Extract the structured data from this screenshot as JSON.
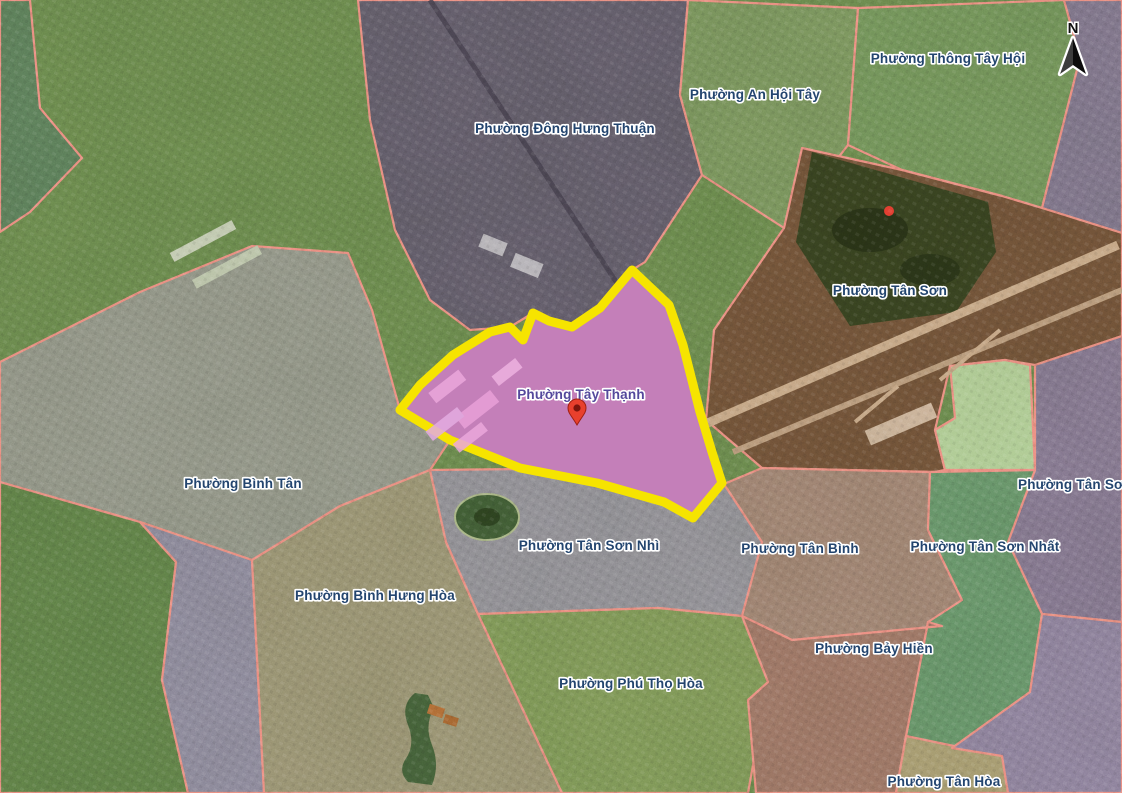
{
  "map": {
    "type": "satellite-ward-boundary-map",
    "highlighted_ward": "Phường Tây Thạnh",
    "compass_label": "N",
    "colors": {
      "highlight_fill": "#d47cc4",
      "highlight_border": "#f6e400",
      "boundary_line": "#ef8b80",
      "label_text": "#23456f",
      "highlight_label_text": "#54489c",
      "marker_red": "#e8402d"
    },
    "marker": {
      "x": 577,
      "y": 425
    },
    "labels": [
      {
        "text": "Phường Đông Hưng Thuận",
        "x": 565,
        "y": 133
      },
      {
        "text": "Phường An Hội Tây",
        "x": 755,
        "y": 99
      },
      {
        "text": "Phường Thông Tây Hội",
        "x": 948,
        "y": 63
      },
      {
        "text": "Phường Tân Sơn",
        "x": 890,
        "y": 295
      },
      {
        "text": "Phường Tây Thạnh",
        "x": 581,
        "y": 399,
        "color": "#54489c"
      },
      {
        "text": "Phường Bình Tân",
        "x": 243,
        "y": 488
      },
      {
        "text": "Phường Tân Sơn Nhì",
        "x": 589,
        "y": 550
      },
      {
        "text": "Phường Tân Bình",
        "x": 800,
        "y": 553
      },
      {
        "text": "Phường Tân Sơn Nhất",
        "x": 985,
        "y": 551
      },
      {
        "text": "Phường Tân Sơn H",
        "x": 1018,
        "y": 489,
        "anchor": "start"
      },
      {
        "text": "Phường Bình Hưng Hòa",
        "x": 375,
        "y": 600
      },
      {
        "text": "Phường Bảy Hiền",
        "x": 874,
        "y": 653
      },
      {
        "text": "Phường Phú Thọ Hòa",
        "x": 631,
        "y": 688
      },
      {
        "text": "Phường Tân Hòa",
        "x": 944,
        "y": 786
      }
    ]
  }
}
